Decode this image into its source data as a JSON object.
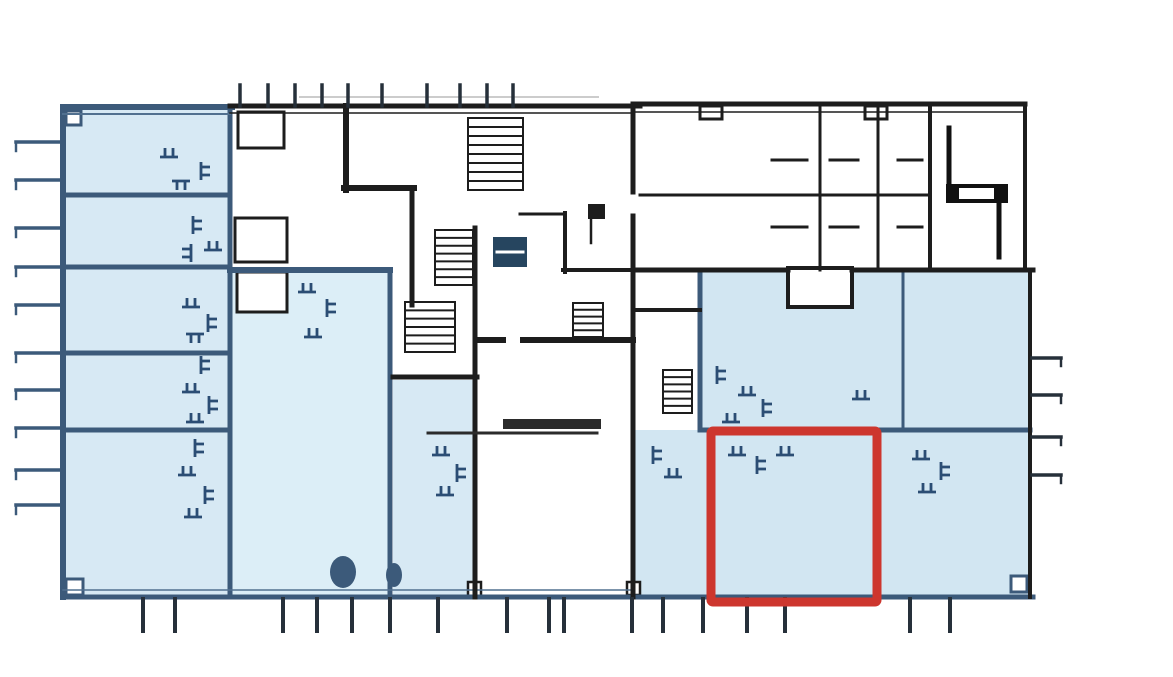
{
  "meta": {
    "kind": "scanned architectural floor plan",
    "width": 1173,
    "height": 677,
    "background": "#ffffff"
  },
  "colors": {
    "bg": "#ffffff",
    "roomA": "#d7e9f4",
    "roomB": "#dceef7",
    "roomC": "#d2e6f2",
    "navy": "#3c5a7a",
    "navyThin": "#51708f",
    "black": "#1d1d1d",
    "gray": "#cccccc",
    "tick": "#26303a",
    "furn": "#2b4d74",
    "darkbox": "#26455f",
    "ink": "#111111",
    "counter": "#2b2b2b",
    "white": "#ffffff",
    "red": "#cd362e"
  },
  "floor_plan": {
    "width": 1173,
    "height": 677,
    "fills": [
      {
        "x": 63,
        "y": 108,
        "w": 167,
        "h": 489,
        "fill": "roomA",
        "name": "left-wing-rooms"
      },
      {
        "x": 230,
        "y": 270,
        "w": 160,
        "h": 327,
        "fill": "roomB",
        "name": "central-room"
      },
      {
        "x": 393,
        "y": 380,
        "w": 82,
        "h": 217,
        "fill": "roomA",
        "name": "mid-room"
      },
      {
        "x": 700,
        "y": 270,
        "w": 330,
        "h": 160,
        "fill": "roomC",
        "name": "right-wing-upper"
      },
      {
        "x": 633,
        "y": 430,
        "w": 397,
        "h": 167,
        "fill": "roomC",
        "name": "right-wing-lower"
      }
    ],
    "white_rooms": [
      {
        "x": 788,
        "y": 268,
        "w": 64,
        "h": 39,
        "stroke": "black",
        "sw": 4,
        "name": "alcove"
      },
      {
        "x": 238,
        "y": 112,
        "w": 46,
        "h": 36,
        "stroke": "black",
        "sw": 3,
        "name": "small-room"
      },
      {
        "x": 235,
        "y": 218,
        "w": 52,
        "h": 44,
        "stroke": "black",
        "sw": 3,
        "name": "small-room"
      },
      {
        "x": 237,
        "y": 272,
        "w": 50,
        "h": 40,
        "stroke": "black",
        "sw": 3,
        "name": "small-room"
      },
      {
        "x": 66,
        "y": 111,
        "w": 15,
        "h": 14,
        "stroke": "navy",
        "sw": 3,
        "name": "corner-post"
      },
      {
        "x": 66,
        "y": 579,
        "w": 17,
        "h": 16,
        "stroke": "navy",
        "sw": 3,
        "name": "corner-post"
      },
      {
        "x": 1011,
        "y": 576,
        "w": 16,
        "h": 16,
        "stroke": "navy",
        "sw": 3,
        "name": "corner-post"
      },
      {
        "x": 468,
        "y": 582,
        "w": 13,
        "h": 14,
        "stroke": "black",
        "sw": 2.5,
        "name": "corner-post"
      },
      {
        "x": 627,
        "y": 582,
        "w": 13,
        "h": 13,
        "stroke": "black",
        "sw": 2.5,
        "name": "corner-post"
      },
      {
        "x": 700,
        "y": 106,
        "w": 22,
        "h": 13,
        "stroke": "black",
        "sw": 3,
        "name": "top-notch"
      },
      {
        "x": 865,
        "y": 106,
        "w": 22,
        "h": 13,
        "stroke": "black",
        "sw": 3,
        "name": "top-notch"
      }
    ],
    "walls": [
      [
        63,
        107,
        232,
        107,
        6,
        "navy"
      ],
      [
        63,
        107,
        63,
        597,
        6,
        "navy"
      ],
      [
        63,
        597,
        1033,
        597,
        5,
        "navy"
      ],
      [
        63,
        195,
        230,
        195,
        5,
        "navy"
      ],
      [
        63,
        267,
        230,
        267,
        5,
        "navy"
      ],
      [
        63,
        353,
        230,
        353,
        5,
        "navy"
      ],
      [
        63,
        430,
        230,
        430,
        5,
        "navy"
      ],
      [
        230,
        107,
        230,
        597,
        5,
        "navy"
      ],
      [
        230,
        270,
        390,
        270,
        6,
        "navy"
      ],
      [
        390,
        270,
        390,
        597,
        5,
        "navy"
      ],
      [
        700,
        272,
        700,
        430,
        5,
        "navy"
      ],
      [
        700,
        430,
        1030,
        430,
        5,
        "navy"
      ],
      [
        903,
        272,
        903,
        428,
        3,
        "navy"
      ],
      [
        63,
        114,
        230,
        114,
        2,
        "navyThin"
      ],
      [
        63,
        590,
        633,
        590,
        1.5,
        "navyThin"
      ],
      [
        230,
        106,
        640,
        106,
        5,
        "black"
      ],
      [
        230,
        113,
        633,
        113,
        1.5,
        "black"
      ],
      [
        633,
        104,
        1025,
        104,
        5,
        "black"
      ],
      [
        633,
        112,
        1025,
        112,
        1.5,
        "black"
      ],
      [
        1025,
        104,
        1025,
        270,
        4,
        "black"
      ],
      [
        1030,
        270,
        1030,
        597,
        4,
        "black"
      ],
      [
        1022,
        270,
        1033,
        270,
        4,
        "black"
      ],
      [
        346,
        106,
        346,
        190,
        6,
        "black"
      ],
      [
        344,
        188,
        414,
        188,
        6,
        "black"
      ],
      [
        412,
        188,
        412,
        305,
        5,
        "black"
      ],
      [
        393,
        377,
        477,
        377,
        5,
        "black"
      ],
      [
        475,
        228,
        475,
        597,
        5,
        "black"
      ],
      [
        480,
        340,
        503,
        340,
        6,
        "black"
      ],
      [
        523,
        340,
        633,
        340,
        6,
        "black"
      ],
      [
        633,
        106,
        633,
        192,
        5,
        "black"
      ],
      [
        633,
        216,
        633,
        597,
        5,
        "black"
      ],
      [
        633,
        270,
        788,
        270,
        5,
        "black"
      ],
      [
        852,
        270,
        1033,
        270,
        5,
        "black"
      ],
      [
        633,
        310,
        700,
        310,
        4,
        "black"
      ],
      [
        640,
        195,
        930,
        195,
        3,
        "black"
      ],
      [
        820,
        106,
        820,
        270,
        3,
        "black"
      ],
      [
        878,
        106,
        878,
        270,
        3,
        "black"
      ],
      [
        930,
        104,
        930,
        270,
        4,
        "black"
      ],
      [
        565,
        213,
        565,
        272,
        4,
        "black"
      ],
      [
        563,
        270,
        633,
        270,
        4,
        "black"
      ],
      [
        520,
        214,
        565,
        214,
        3,
        "black"
      ]
    ],
    "stairs": [
      {
        "x": 468,
        "y": 118,
        "w": 55,
        "h": 72,
        "steps": 8
      },
      {
        "x": 435,
        "y": 230,
        "w": 38,
        "h": 55,
        "steps": 7
      },
      {
        "x": 405,
        "y": 302,
        "w": 50,
        "h": 50,
        "steps": 6
      },
      {
        "x": 663,
        "y": 370,
        "w": 29,
        "h": 43,
        "steps": 6
      },
      {
        "x": 573,
        "y": 303,
        "w": 30,
        "h": 34,
        "steps": 5
      }
    ],
    "misc": [
      {
        "t": "line",
        "x1": 300,
        "y1": 97,
        "x2": 598,
        "y2": 97,
        "w": 2,
        "c": "gray",
        "n": "scan-artifact"
      },
      {
        "t": "line",
        "x1": 949,
        "y1": 128,
        "x2": 949,
        "y2": 186,
        "w": 5,
        "c": "ink",
        "n": "entrance-symbol-line"
      },
      {
        "t": "rect",
        "x": 946,
        "y": 184,
        "w": 62,
        "h": 19,
        "f": "ink",
        "n": "entrance-symbol-bar"
      },
      {
        "t": "rect",
        "x": 959,
        "y": 188,
        "w": 35,
        "h": 11,
        "f": "white",
        "n": "entrance-symbol-bar-inner"
      },
      {
        "t": "line",
        "x1": 999,
        "y1": 203,
        "x2": 999,
        "y2": 257,
        "w": 5,
        "c": "ink",
        "n": "entrance-symbol-line"
      },
      {
        "t": "rect",
        "x": 493,
        "y": 237,
        "w": 34,
        "h": 30,
        "f": "darkbox",
        "n": "shaft-box"
      },
      {
        "t": "line",
        "x1": 497,
        "y1": 252,
        "x2": 523,
        "y2": 252,
        "w": 3,
        "c": "white",
        "n": "shaft-box-line"
      },
      {
        "t": "rect",
        "x": 588,
        "y": 204,
        "w": 17,
        "h": 15,
        "f": "black",
        "n": "shaft-box"
      },
      {
        "t": "line",
        "x1": 591,
        "y1": 219,
        "x2": 591,
        "y2": 243,
        "w": 2.5,
        "c": "black",
        "n": "shaft-stem"
      },
      {
        "t": "rect",
        "x": 503,
        "y": 419,
        "w": 98,
        "h": 10,
        "f": "counter",
        "n": "counter"
      },
      {
        "t": "line",
        "x1": 428,
        "y1": 433,
        "x2": 597,
        "y2": 433,
        "w": 3,
        "c": "counter",
        "n": "counter-line"
      },
      {
        "t": "ellipse",
        "cx": 343,
        "cy": 572,
        "rx": 13,
        "ry": 16,
        "f": "navy",
        "n": "plan-blob"
      },
      {
        "t": "ellipse",
        "cx": 394,
        "cy": 575,
        "rx": 8,
        "ry": 12,
        "f": "navy",
        "n": "plan-blob"
      },
      {
        "t": "line",
        "x1": 772,
        "y1": 160,
        "x2": 807,
        "y2": 160,
        "w": 3,
        "c": "black",
        "n": "parking-dash"
      },
      {
        "t": "line",
        "x1": 830,
        "y1": 160,
        "x2": 858,
        "y2": 160,
        "w": 3,
        "c": "black",
        "n": "parking-dash"
      },
      {
        "t": "line",
        "x1": 898,
        "y1": 160,
        "x2": 922,
        "y2": 160,
        "w": 3,
        "c": "black",
        "n": "parking-dash"
      },
      {
        "t": "line",
        "x1": 772,
        "y1": 227,
        "x2": 807,
        "y2": 227,
        "w": 3,
        "c": "black",
        "n": "parking-dash"
      },
      {
        "t": "line",
        "x1": 830,
        "y1": 227,
        "x2": 858,
        "y2": 227,
        "w": 3,
        "c": "black",
        "n": "parking-dash"
      },
      {
        "t": "line",
        "x1": 898,
        "y1": 227,
        "x2": 922,
        "y2": 227,
        "w": 3,
        "c": "black",
        "n": "parking-dash"
      }
    ],
    "ticks": [
      {
        "name": "window-tick-top",
        "dir": "v",
        "a1": 85,
        "a2": 106,
        "w": 3.5,
        "c": "tick",
        "stub": 0,
        "positions": [
          240,
          268,
          295,
          322,
          348,
          382,
          427,
          460,
          487,
          513
        ]
      },
      {
        "name": "window-tick-bottom",
        "dir": "v",
        "a1": 631,
        "a2": 599,
        "w": 4,
        "c": "tick",
        "stub": 0,
        "positions": [
          143,
          175,
          283,
          317,
          352,
          390,
          438,
          507,
          549,
          564,
          632,
          663,
          703,
          747,
          785,
          910,
          950
        ]
      },
      {
        "name": "window-tick-left",
        "dir": "h",
        "a1": 16,
        "a2": 62,
        "w": 3.5,
        "c": "navy",
        "stub": 9,
        "positions": [
          142,
          180,
          228,
          267,
          305,
          353,
          390,
          428,
          470,
          505
        ]
      },
      {
        "name": "window-tick-right",
        "dir": "h",
        "a1": 1061,
        "a2": 1032,
        "w": 3.5,
        "c": "tick",
        "stub": 8,
        "positions": [
          358,
          395,
          437,
          475
        ]
      }
    ],
    "furniture": {
      "glyph": "M0 9 H18 M5 0 V9 M13 0 V9",
      "stroke": "furn",
      "w": 2.8,
      "placements": [
        [
          160,
          148,
          0
        ],
        [
          196,
          166,
          90
        ],
        [
          172,
          180,
          180
        ],
        [
          188,
          220,
          90
        ],
        [
          204,
          241,
          0
        ],
        [
          178,
          248,
          270
        ],
        [
          182,
          298,
          0
        ],
        [
          203,
          318,
          90
        ],
        [
          186,
          333,
          180
        ],
        [
          196,
          360,
          90
        ],
        [
          182,
          383,
          0
        ],
        [
          204,
          400,
          90
        ],
        [
          186,
          413,
          0
        ],
        [
          190,
          443,
          90
        ],
        [
          178,
          466,
          0
        ],
        [
          200,
          490,
          90
        ],
        [
          184,
          508,
          0
        ],
        [
          298,
          283,
          0
        ],
        [
          322,
          303,
          90
        ],
        [
          304,
          328,
          0
        ],
        [
          432,
          446,
          0
        ],
        [
          452,
          468,
          90
        ],
        [
          436,
          486,
          0
        ],
        [
          712,
          370,
          90
        ],
        [
          738,
          386,
          0
        ],
        [
          758,
          403,
          90
        ],
        [
          722,
          413,
          0
        ],
        [
          852,
          390,
          0
        ],
        [
          648,
          450,
          90
        ],
        [
          664,
          468,
          0
        ],
        [
          728,
          446,
          0
        ],
        [
          752,
          460,
          90
        ],
        [
          776,
          446,
          0
        ],
        [
          912,
          450,
          0
        ],
        [
          936,
          466,
          90
        ],
        [
          918,
          483,
          0
        ]
      ]
    },
    "highlight": {
      "name": "highlighted-unit-outline",
      "x": 711,
      "y": 431,
      "w": 166,
      "h": 171,
      "sw": 9,
      "c": "red"
    }
  }
}
